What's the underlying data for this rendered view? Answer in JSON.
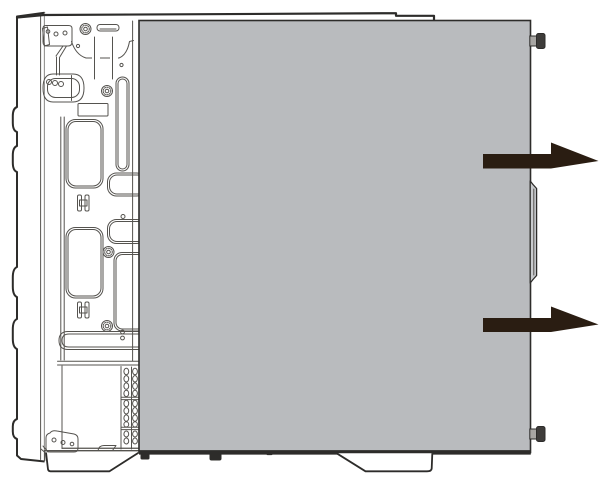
{
  "canvas": {
    "width": 607,
    "height": 485
  },
  "figure": {
    "type": "technical-line-illustration",
    "subject": "desktop-computer-tower-side-view",
    "depicts": "side-panel-slid-toward-rear-for-removal",
    "text_labels": [],
    "arrows": [
      {
        "name": "slide-direction-arrow-upper",
        "direction": "right"
      },
      {
        "name": "slide-direction-arrow-lower",
        "direction": "right"
      }
    ],
    "thumbscrew_count": 2
  },
  "colors": {
    "background": "#ffffff",
    "panel": "#b9bbbe",
    "panel_lip": "#c9cbce",
    "line_dark": "#2d2c2a",
    "line_thin": "#55534f",
    "arrow": "#2a1d12",
    "screw_cap": "#3e3c3a",
    "screw_neck": "#a8a6a3",
    "tab": "#2d2c2a"
  }
}
